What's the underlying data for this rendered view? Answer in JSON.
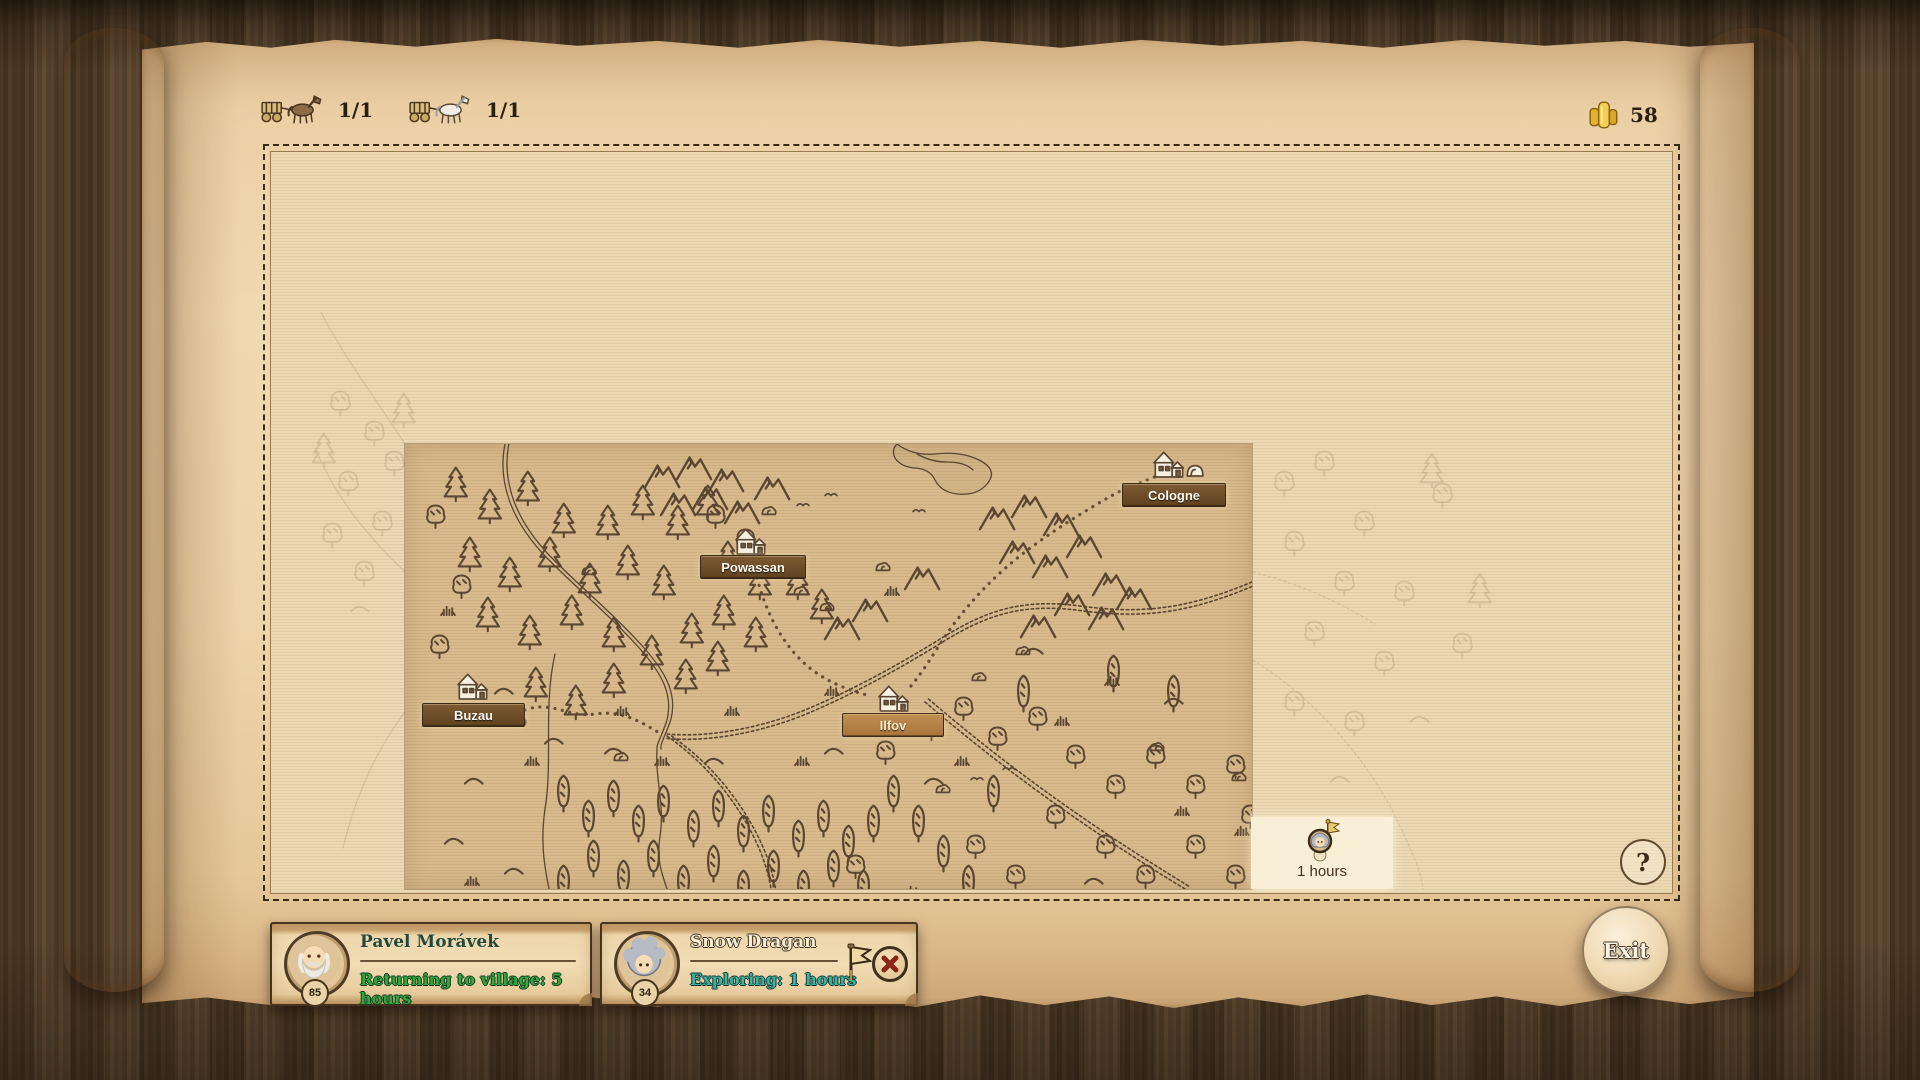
{
  "topbar": {
    "caravans": [
      {
        "icon": "cart-brown-horse-icon",
        "count": "1/1"
      },
      {
        "icon": "cart-white-horse-icon",
        "count": "1/1"
      }
    ],
    "gold": {
      "icon": "gold-coins-icon",
      "amount": "58"
    }
  },
  "map": {
    "locations": [
      {
        "label": "Cologne",
        "highlighted": false
      },
      {
        "label": "Powassan",
        "highlighted": false
      },
      {
        "label": "Buzau",
        "highlighted": false
      },
      {
        "label": "Ilfov",
        "highlighted": true
      }
    ],
    "selection": {
      "icon": "traveler-flag-marker-icon",
      "duration": "1 hours"
    },
    "help": "?"
  },
  "parties": [
    {
      "name": "Pavel Morávek",
      "level": "85",
      "status": "Returning to village: 5 hours"
    },
    {
      "name": "Snow Dragan",
      "level": "34",
      "status": "Exploring: 1 hours",
      "flag_icon": "flag-icon",
      "cancel_icon": "cancel-x-icon"
    }
  ],
  "exit_label": "Exit",
  "colors": {
    "label_bg": "#6b4a28",
    "label_bg_active": "#b8834a",
    "status_green": "#2fa83c",
    "status_teal": "#3cb3a2",
    "parchment": "#f0d8b0",
    "map_unexplored": "#ecd9b4",
    "map_revealed": "#d9ba8c",
    "wood": "#503b26",
    "gold": "#f4cf55",
    "ink": "#4e3a28"
  }
}
